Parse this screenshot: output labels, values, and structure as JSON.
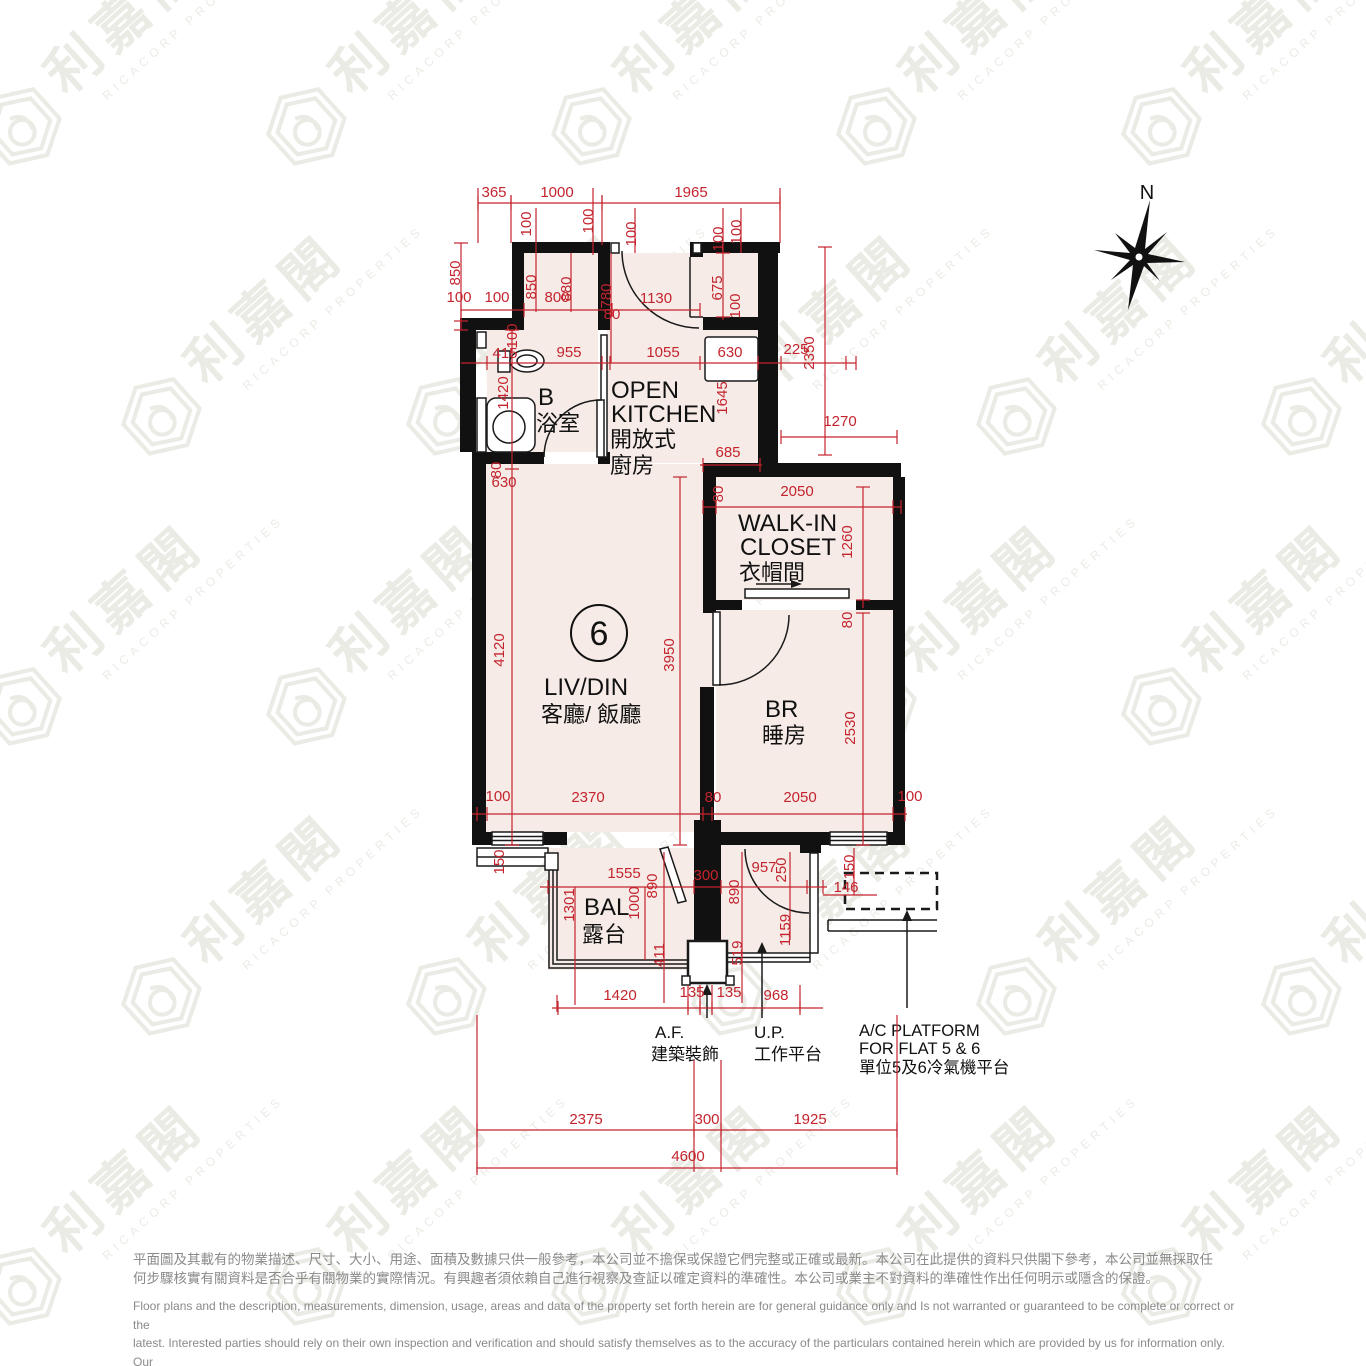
{
  "colors": {
    "dim_red": "#c4242e",
    "room_fill": "#f6ebe7",
    "wall": "#111111",
    "gray_text": "#8a8a8a",
    "watermark": "#ebebe6"
  },
  "compass": {
    "label": "N"
  },
  "unit": {
    "number": "6"
  },
  "rooms": {
    "bath": {
      "en": "B",
      "zh": "浴室"
    },
    "kitchen": {
      "l1": "OPEN",
      "l2": "KITCHEN",
      "l3": "開放式",
      "l4": "廚房"
    },
    "closet": {
      "l1": "WALK-IN",
      "l2": "CLOSET",
      "l3": "衣帽間"
    },
    "livdin": {
      "en": "LIV/DIN",
      "zh": "客廳/ 飯廳"
    },
    "br": {
      "en": "BR",
      "zh": "睡房"
    },
    "bal": {
      "en": "BAL",
      "zh": "露台"
    },
    "af": {
      "en": "A.F.",
      "zh": "建築裝飾"
    },
    "up": {
      "en": "U.P.",
      "zh": "工作平台"
    },
    "ac": {
      "l1": "A/C PLATFORM",
      "l2": "FOR FLAT 5 & 6",
      "l3": "單位5及6冷氣機平台"
    }
  },
  "watermark": {
    "zh": "利嘉閣",
    "en": "RICACORP PROPERTIES"
  },
  "disclaimer": {
    "zh": [
      "平面圖及其載有的物業描述、尺寸、大小、用途、面積及數據只供一般參考，本公司並不擔保或保證它們完整或正確或最新。本公司在此提供的資料只供閣下參考，本公司並無採取任",
      "何步驟核實有關資料是否合乎有關物業的實際情況。有興趣者須依賴自己進行視察及查証以確定資料的準確性。本公司或業主不對資料的準確性作出任何明示或隱含的保證。"
    ],
    "en": [
      "Floor plans and the description, measurements, dimension, usage, areas and data of the property set forth herein are for general guidance only and Is not warranted or guaranteed to be complete or correct or the",
      "latest. Interested parties should rely on their own inspection and verification and should satisfy themselves as to the accuracy of the particulars contained herein which are provided by us for information only.  Our",
      "Company has not taken any step to verify whether the information reflects the actual status of the property.  No warranty for accuracy is given or implied by the owners or us."
    ]
  },
  "dimensions": [
    {
      "t": "365",
      "x": 494,
      "y": 197,
      "r": 0
    },
    {
      "t": "1000",
      "x": 557,
      "y": 197,
      "r": 0
    },
    {
      "t": "1965",
      "x": 691,
      "y": 197,
      "r": 0
    },
    {
      "t": "100",
      "x": 531,
      "y": 224,
      "r": 1
    },
    {
      "t": "100",
      "x": 593,
      "y": 221,
      "r": 1
    },
    {
      "t": "100",
      "x": 636,
      "y": 234,
      "r": 1
    },
    {
      "t": "100",
      "x": 723,
      "y": 239,
      "r": 1
    },
    {
      "t": "100",
      "x": 741,
      "y": 232,
      "r": 1
    },
    {
      "t": "850",
      "x": 460,
      "y": 273,
      "r": 1
    },
    {
      "t": "100",
      "x": 459,
      "y": 302,
      "r": 0
    },
    {
      "t": "100",
      "x": 497,
      "y": 302,
      "r": 0
    },
    {
      "t": "850",
      "x": 536,
      "y": 287,
      "r": 1
    },
    {
      "t": "800",
      "x": 557,
      "y": 302,
      "r": 0
    },
    {
      "t": "880",
      "x": 571,
      "y": 289,
      "r": 1
    },
    {
      "t": "780",
      "x": 611,
      "y": 296,
      "r": 1
    },
    {
      "t": "1130",
      "x": 656,
      "y": 303,
      "r": 0
    },
    {
      "t": "80",
      "x": 612,
      "y": 319,
      "r": 0
    },
    {
      "t": "675",
      "x": 722,
      "y": 288,
      "r": 1
    },
    {
      "t": "100",
      "x": 740,
      "y": 306,
      "r": 1
    },
    {
      "t": "100",
      "x": 517,
      "y": 336,
      "r": 1
    },
    {
      "t": "415",
      "x": 505,
      "y": 358,
      "r": 0
    },
    {
      "t": "955",
      "x": 569,
      "y": 357,
      "r": 0
    },
    {
      "t": "1055",
      "x": 663,
      "y": 357,
      "r": 0
    },
    {
      "t": "630",
      "x": 730,
      "y": 357,
      "r": 0
    },
    {
      "t": "225",
      "x": 796,
      "y": 354,
      "r": 0
    },
    {
      "t": "2350",
      "x": 814,
      "y": 353,
      "r": 1
    },
    {
      "t": "1420",
      "x": 508,
      "y": 393,
      "r": 1
    },
    {
      "t": "1645",
      "x": 727,
      "y": 398,
      "r": 1
    },
    {
      "t": "1270",
      "x": 840,
      "y": 426,
      "r": 0
    },
    {
      "t": "685",
      "x": 728,
      "y": 457,
      "r": 0
    },
    {
      "t": "80",
      "x": 501,
      "y": 470,
      "r": 1
    },
    {
      "t": "630",
      "x": 504,
      "y": 487,
      "r": 0
    },
    {
      "t": "80",
      "x": 723,
      "y": 494,
      "r": 1
    },
    {
      "t": "2050",
      "x": 797,
      "y": 496,
      "r": 0
    },
    {
      "t": "1260",
      "x": 852,
      "y": 542,
      "r": 1
    },
    {
      "t": "80",
      "x": 852,
      "y": 620,
      "r": 1
    },
    {
      "t": "4120",
      "x": 504,
      "y": 650,
      "r": 1
    },
    {
      "t": "3950",
      "x": 674,
      "y": 655,
      "r": 1
    },
    {
      "t": "2530",
      "x": 855,
      "y": 728,
      "r": 1
    },
    {
      "t": "100",
      "x": 498,
      "y": 801,
      "r": 0
    },
    {
      "t": "2370",
      "x": 588,
      "y": 802,
      "r": 0
    },
    {
      "t": "80",
      "x": 713,
      "y": 802,
      "r": 0
    },
    {
      "t": "2050",
      "x": 800,
      "y": 802,
      "r": 0
    },
    {
      "t": "100",
      "x": 910,
      "y": 801,
      "r": 0
    },
    {
      "t": "150",
      "x": 504,
      "y": 862,
      "r": 1
    },
    {
      "t": "1555",
      "x": 624,
      "y": 878,
      "r": 0
    },
    {
      "t": "300",
      "x": 706,
      "y": 880,
      "r": 0
    },
    {
      "t": "890",
      "x": 657,
      "y": 886,
      "r": 1
    },
    {
      "t": "1000",
      "x": 639,
      "y": 903,
      "r": 1
    },
    {
      "t": "1301",
      "x": 574,
      "y": 905,
      "r": 1
    },
    {
      "t": "957",
      "x": 764,
      "y": 872,
      "r": 0
    },
    {
      "t": "890",
      "x": 739,
      "y": 892,
      "r": 1
    },
    {
      "t": "250",
      "x": 786,
      "y": 870,
      "r": 1
    },
    {
      "t": "150",
      "x": 854,
      "y": 867,
      "r": 1
    },
    {
      "t": "146",
      "x": 846,
      "y": 892,
      "r": 0
    },
    {
      "t": "1159",
      "x": 790,
      "y": 930,
      "r": 1
    },
    {
      "t": "411",
      "x": 664,
      "y": 955,
      "r": 1
    },
    {
      "t": "519",
      "x": 742,
      "y": 953,
      "r": 1
    },
    {
      "t": "1420",
      "x": 620,
      "y": 1000,
      "r": 0
    },
    {
      "t": "135",
      "x": 692,
      "y": 997,
      "r": 0
    },
    {
      "t": "135",
      "x": 729,
      "y": 997,
      "r": 0
    },
    {
      "t": "968",
      "x": 776,
      "y": 1000,
      "r": 0
    },
    {
      "t": "2375",
      "x": 586,
      "y": 1124,
      "r": 0
    },
    {
      "t": "300",
      "x": 707,
      "y": 1124,
      "r": 0
    },
    {
      "t": "1925",
      "x": 810,
      "y": 1124,
      "r": 0
    },
    {
      "t": "4600",
      "x": 688,
      "y": 1161,
      "r": 0
    }
  ]
}
